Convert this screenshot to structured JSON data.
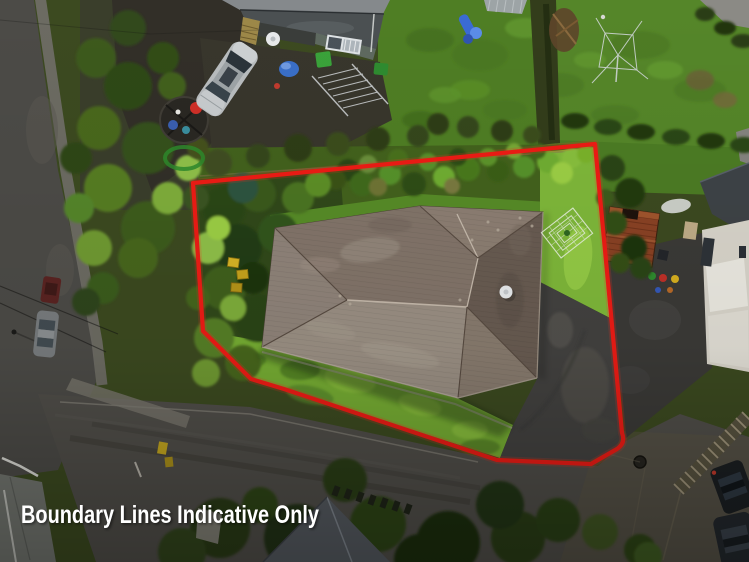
{
  "photo": {
    "kind": "aerial-drone-photo",
    "subject": "single-storey hip-roof house on a fenced corner section with lawn, trees and shared driveway"
  },
  "caption": {
    "text": "Boundary Lines Indicative Only",
    "color": "#ffffff"
  },
  "boundary": {
    "color": "#ee1c15",
    "glow_color": "#ff3020",
    "stroke_width": 4.2
  },
  "palette": {
    "lawn_main": "#558629",
    "lawn_neighbor": "#4f7e24",
    "lawn_backyard": "#76ad33",
    "lawn_strip": "#7fb83a",
    "roof_light": "#9b9084",
    "roof_mid": "#83756a",
    "roof_dark": "#695c52",
    "road": "#504e49",
    "driveway": "#434240",
    "soil_dark": "#322f28"
  }
}
